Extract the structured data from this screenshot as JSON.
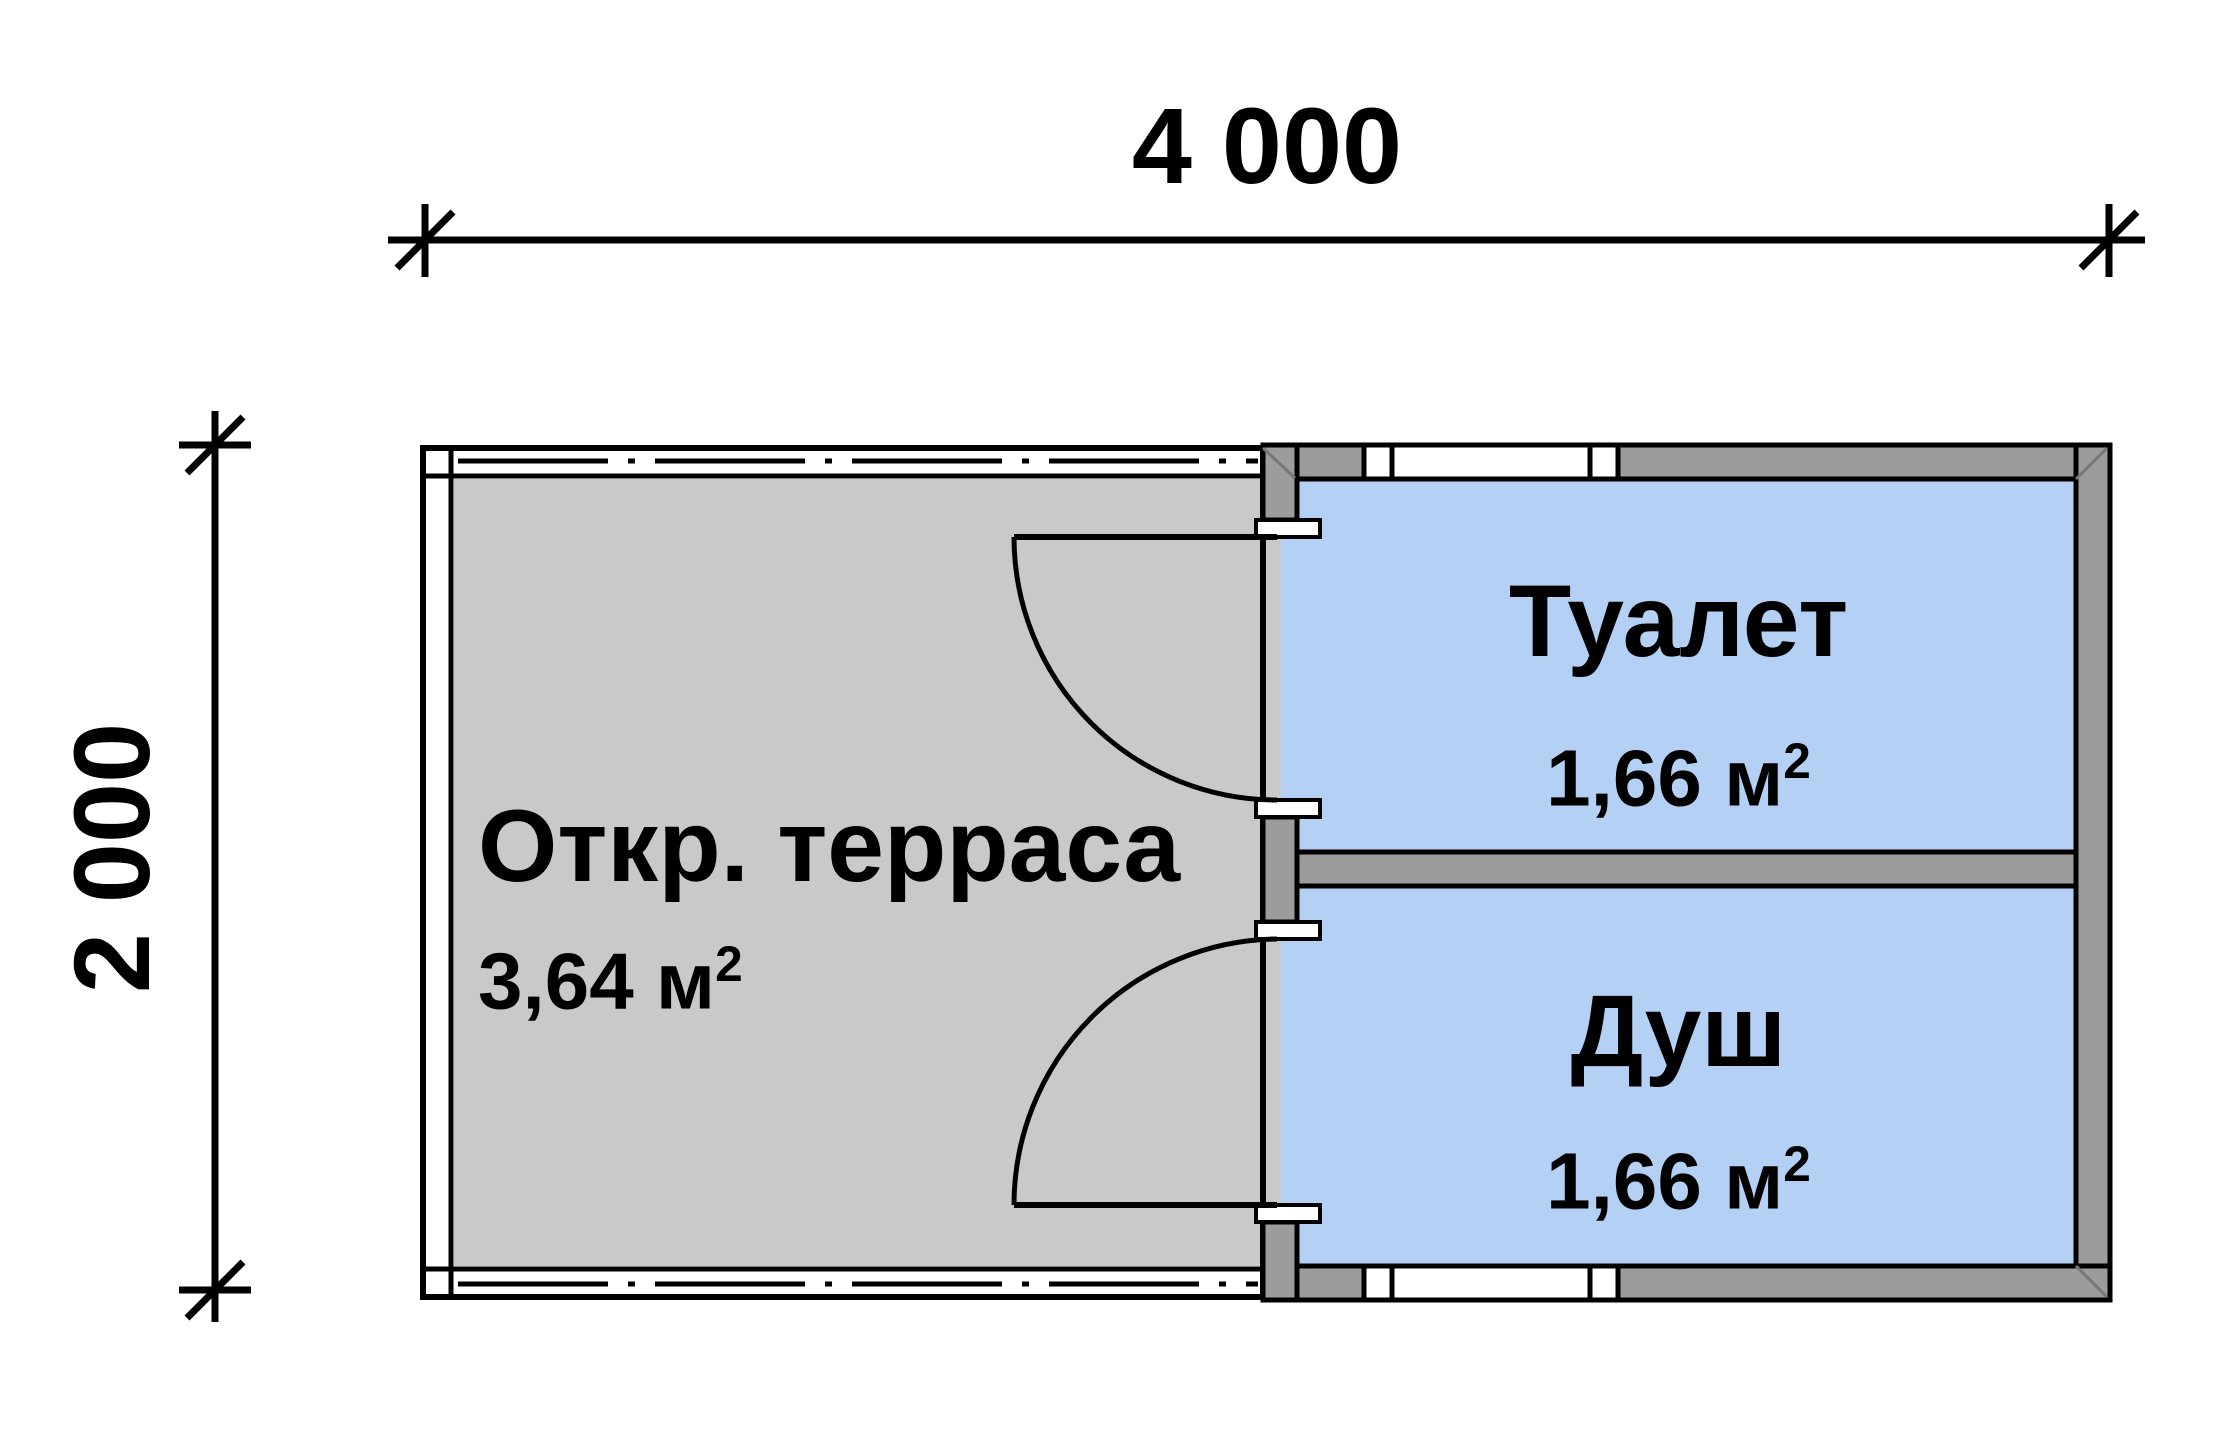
{
  "plan": {
    "width_label": "4 000",
    "height_label": "2 000",
    "rooms": {
      "terrace": {
        "name": "Откр. терраса",
        "area": "3,64 м",
        "area_sup": "2"
      },
      "toilet": {
        "name": "Туалет",
        "area": "1,66 м",
        "area_sup": "2"
      },
      "shower": {
        "name": "Душ",
        "area": "1,66 м",
        "area_sup": "2"
      }
    }
  },
  "colors": {
    "terrace_floor": "#c9c9c9",
    "room_floor": "#b4d0f4",
    "wall": "#9c9c9c",
    "line": "#000000"
  }
}
